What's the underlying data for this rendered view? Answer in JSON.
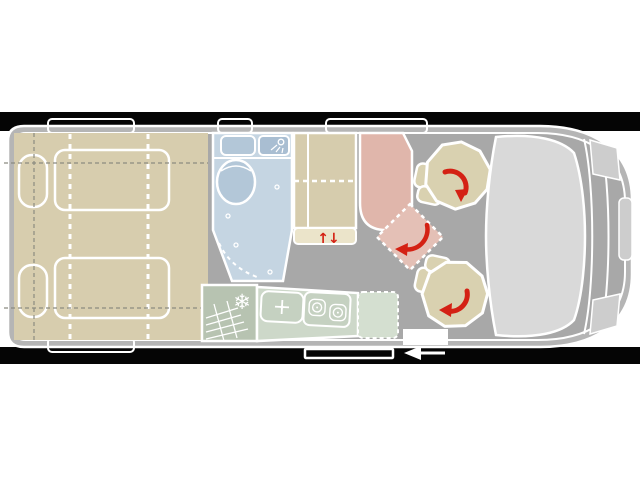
{
  "colors": {
    "band": "#050505",
    "body_border": "#b5b5b5",
    "floor": "#a8a8a8",
    "outline": "#ffffff",
    "bed": "#d7cdae",
    "bathroom": "#c5d5e2",
    "fixture": "#b3c7d8",
    "fixture_dark": "#a9bed2",
    "wardrobe": "#d6ccad",
    "shelf": "#ebe4ca",
    "table": "#e0b6ab",
    "diamond": "#e4c0b6",
    "seat": "#d9d1b0",
    "fridge": "#b7c3b1",
    "counter": "#cdd8c9",
    "appliance": "#c5d1c1",
    "extension": "#d4dfd0",
    "windshield": "#d9d9d9",
    "front_accent": "#cdcdcd",
    "red": "#d42114",
    "dash": "#8b8b80",
    "step": "#ffffff"
  },
  "icons": {
    "snowflake": "❄",
    "lift_arrows": "↑↓",
    "rotate_arrow": "curved-red-arrow",
    "direction_arrow": "left-arrow",
    "faucet": "cross-spark",
    "burner": "double-ring",
    "shower": "shower-head"
  }
}
